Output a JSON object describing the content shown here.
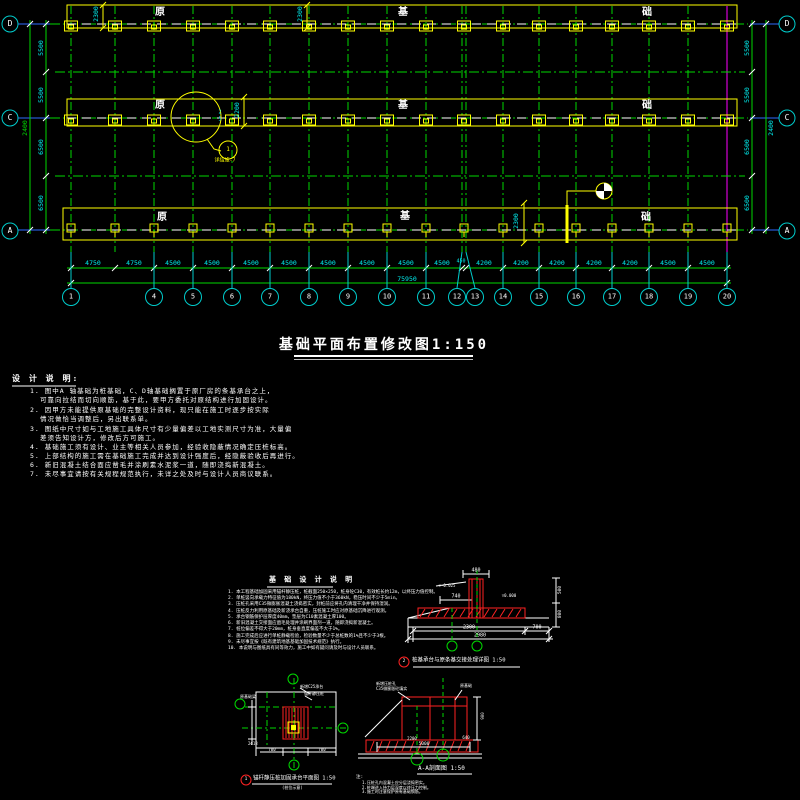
{
  "title": "基础平面布置修改图1:150",
  "plan": {
    "row_axes_left": [
      "D",
      "C",
      "A"
    ],
    "row_axes_right": [
      "D",
      "C",
      "A"
    ],
    "col_axes": [
      "1",
      "4",
      "5",
      "6",
      "7",
      "8",
      "9",
      "10",
      "11",
      "12",
      "13",
      "14",
      "15",
      "16",
      "17",
      "18",
      "19",
      "20"
    ],
    "band_label_chars": [
      "原",
      "基",
      "础"
    ],
    "dims_bottom": [
      "4750",
      "4750",
      "4500",
      "4500",
      "4500",
      "4500",
      "4500",
      "4500",
      "4500",
      "4500",
      "450",
      "4200",
      "4200",
      "4200",
      "4200",
      "4200",
      "4500",
      "4500"
    ],
    "dim_total": "75950",
    "dims_left": [
      "5500",
      "5500",
      "6500",
      "6500"
    ],
    "dim_left_offset": "2400",
    "dims_right": [
      "5500",
      "5500",
      "6500",
      "6500"
    ],
    "dim_right_offset": "2400",
    "dims_top": [
      "2300",
      "2300"
    ],
    "dim_mid": "2200",
    "dim_mid_small_top": "2",
    "dim_mid_small_bot": "5",
    "dim_band_a": "2300",
    "ref_bubble_text": "1",
    "ref_bubble_note": "详结施-7"
  },
  "design_notes": {
    "header": "设 计 说 明:",
    "lines": [
      "1. 图中A 轴基础为桩基础，C、D轴基础搁置于原厂房的条基承台之上，",
      "可靠向拉结而切向顺筋，基于此，要甲方委托对原结构进行加固设计。",
      "2. 因甲方未能提供原基础的完整设计资料，现只能在施工时逐步按实际",
      "情况做恰当调整后，另出联系单。",
      "3. 图纸中尺寸如与工地施工具体尺寸有少量偏差以工地实测尺寸为准，大量偏",
      "差须告知设计方，修改后方可施工。",
      "4. 基础施工须有设计、业主等相关人员参加，经验收隐蔽情况确定压桩标高。",
      "5. 上部结构的施工需在基础施工完成并达到设计强度后，经隐蔽验收后再进行。",
      "6. 新旧混凝土结合面应凿毛并涂刷素水泥浆一道，随即浇捣新混凝土。",
      "7. 未尽事宜请按有关规程规范执行，未详之处及时与设计人员商议联系。"
    ]
  },
  "foundation_notes": {
    "header": "基 础 设 计 说 明",
    "lines": [
      "1. 本工程基础加固采用锚杆静压桩，桩截面250×250，桩身砼C30，有效桩长约12m，以终压力值控制。",
      "2. 单桩竖向承载力特征值为180kN，终压力值不小于360kN，稳压时间不少于5min。",
      "3. 压桩孔采用C35微膨胀混凝土浇捣密实，封桩前应将孔内清理干净并保持湿润。",
      "4. 压桩反力利用原基础及新浇承台自重，压桩施工时应对原基础沉降进行观测。",
      "5. 承台钢筋保护层厚度40mm，垫层为C10素混凝土厚100。",
      "6. 新旧混凝土交接面应凿毛处理并涂刷界面剂一道，随即浇捣新混凝土。",
      "7. 桩位偏差不得大于20mm，桩身垂直度偏差不大于1%。",
      "8. 施工完成后应进行单桩静载检验，检验数量不少于总桩数的1%且不少于3根。",
      "9. 未尽事宜按《既有建筑地基基础加固技术规范》执行。",
      "10. 本说明与图纸具有同等效力，施工中如有疑问请及时与设计人员联系。"
    ]
  },
  "details": {
    "a": {
      "caption_num": "2",
      "caption": "桩基承台与原条基交接处理详图 1:50",
      "dim_col_width": "480",
      "lvl_top": "▽-0.025",
      "lvl_zero": "▽0.000",
      "dim_740": "740",
      "dim_2300": "2300",
      "dim_700": "700",
      "dim_total": "2980",
      "dim_r1": "500",
      "dim_r2": "800"
    },
    "b": {
      "caption_num": "1",
      "caption": "锚杆静压桩加固承台平面图 1:50",
      "subcaption": "(桩位示意)",
      "label_1": "原基础梁",
      "label_2": "新增C25承台",
      "label_3": "锚杆静压桩",
      "rebar": "2Φ18",
      "dim_1": "700",
      "dim_2": "700"
    },
    "c": {
      "caption": "A-A剖面图 1:50",
      "label_1": "新增压桩孔",
      "label_2": "C35微膨胀砼填实",
      "label_3": "原基础",
      "dim_2200": "2200",
      "dim_640": "640",
      "dim_5000": "5000",
      "dim_900": "900",
      "notes_header": "注:",
      "notes": [
        "1.压桩孔内混凝土应分层浇捣密实。",
        "2.桩端进入持力层深度以终压力控制。",
        "3.施工时注意保护原有基础钢筋。"
      ]
    }
  }
}
